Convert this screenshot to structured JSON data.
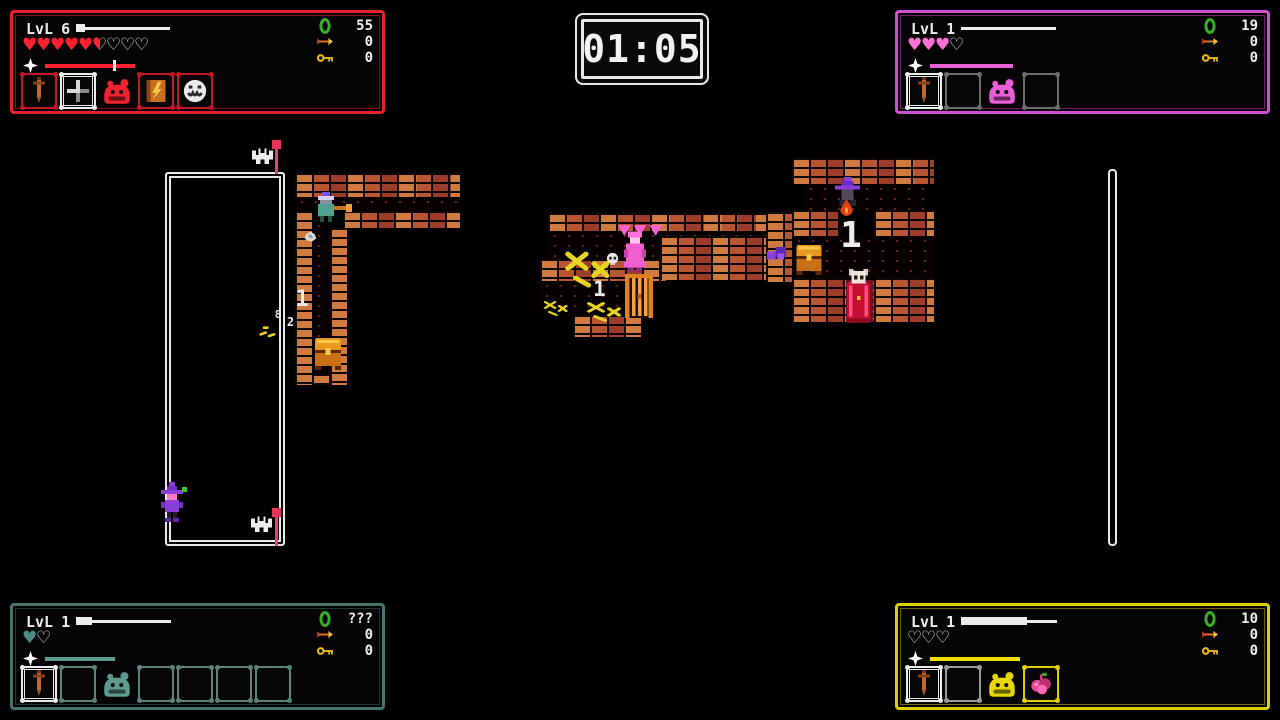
{
  "timer": {
    "value": "01:05"
  },
  "hud": {
    "level_label": "LvL"
  },
  "players": [
    {
      "name": "player-red",
      "corner": "top-left",
      "level": "6",
      "colors": {
        "frame": "#e8212f",
        "frame_dim": "#8a1018",
        "slot_dim": "#c41724",
        "heart": "#ff2030",
        "bar": "#ff2030",
        "slime": "#ee2230"
      },
      "hearts": {
        "full": 5,
        "half": 1,
        "empty": 3
      },
      "xp": {
        "track_w": 94,
        "fill_w": 9
      },
      "wrath": {
        "bar_w": 90,
        "marker": 0.76
      },
      "counters": [
        {
          "icon": "gem",
          "value": "55"
        },
        {
          "icon": "arrow",
          "value": "0"
        },
        {
          "icon": "key",
          "value": "0"
        }
      ],
      "slots": [
        {
          "icon": "sword",
          "frame": "dim"
        },
        {
          "icon": "crosshair",
          "frame": "selected"
        },
        {
          "icon": "slime",
          "frame": "none"
        },
        {
          "icon": "spellbook",
          "frame": "dim"
        },
        {
          "icon": "mask",
          "frame": "dim"
        }
      ]
    },
    {
      "name": "player-pink",
      "corner": "top-right",
      "level": "1",
      "colors": {
        "frame": "#cf4ecf",
        "frame_dim": "#701f70",
        "slot_dim": "#6e6e6e",
        "heart": "#ff70d8",
        "bar": "#ea5ed8",
        "slime": "#ea5ed8"
      },
      "hearts": {
        "full": 3,
        "half": 0,
        "empty": 1
      },
      "xp": {
        "track_w": 95,
        "fill_w": 0
      },
      "wrath": {
        "bar_w": 83,
        "marker": null
      },
      "counters": [
        {
          "icon": "gem",
          "value": "19"
        },
        {
          "icon": "arrow",
          "value": "0"
        },
        {
          "icon": "key",
          "value": "0"
        }
      ],
      "slots": [
        {
          "icon": "sword",
          "frame": "selected"
        },
        {
          "icon": "empty",
          "frame": "dim"
        },
        {
          "icon": "slime",
          "frame": "none"
        },
        {
          "icon": "empty",
          "frame": "dim"
        }
      ]
    },
    {
      "name": "player-teal",
      "corner": "bottom-left",
      "level": "1",
      "colors": {
        "frame": "#44766e",
        "frame_dim": "#1f3a36",
        "slot_dim": "#5d837c",
        "heart": "#4f8c80",
        "bar": "#5d9b8d",
        "slime": "#5d9b8d"
      },
      "hearts": {
        "full": 1,
        "half": 0,
        "empty": 1
      },
      "xp": {
        "track_w": 95,
        "fill_w": 16
      },
      "wrath": {
        "bar_w": 70,
        "marker": null
      },
      "counters": [
        {
          "icon": "gem",
          "value": "???"
        },
        {
          "icon": "arrow",
          "value": "0"
        },
        {
          "icon": "key",
          "value": "0"
        }
      ],
      "slots": [
        {
          "icon": "sword",
          "frame": "selected"
        },
        {
          "icon": "empty",
          "frame": "dim"
        },
        {
          "icon": "slime",
          "frame": "none"
        },
        {
          "icon": "empty",
          "frame": "dim"
        },
        {
          "icon": "empty",
          "frame": "dim"
        },
        {
          "icon": "empty",
          "frame": "dim"
        },
        {
          "icon": "empty",
          "frame": "dim"
        }
      ]
    },
    {
      "name": "player-yellow",
      "corner": "bottom-right",
      "level": "1",
      "colors": {
        "frame": "#ded000",
        "frame_dim": "#6e6700",
        "slot_dim": "#9a9a9a",
        "heart": "#ded000",
        "bar": "#f0e000",
        "slime": "#e6d700"
      },
      "hearts": {
        "full": 0,
        "half": 0,
        "empty": 3
      },
      "xp": {
        "track_w": 96,
        "fill_w": 66
      },
      "wrath": {
        "bar_w": 90,
        "marker": null
      },
      "counters": [
        {
          "icon": "gem",
          "value": "10"
        },
        {
          "icon": "arrow",
          "value": "0"
        },
        {
          "icon": "key",
          "value": "0"
        }
      ],
      "slots": [
        {
          "icon": "sword",
          "frame": "selected"
        },
        {
          "icon": "empty",
          "frame": "dim"
        },
        {
          "icon": "slime",
          "frame": "none"
        },
        {
          "icon": "berries",
          "frame": "accent"
        }
      ]
    }
  ],
  "map": {
    "sprites": [
      {
        "name": "left-room-outline",
        "type": "room",
        "x": 165,
        "y": 172,
        "w": 120,
        "h": 374
      },
      {
        "name": "right-room-wall",
        "type": "wallv",
        "x": 1108,
        "y": 169,
        "w": 9,
        "h": 377
      },
      {
        "name": "brick-wall",
        "type": "brick",
        "x": 295,
        "y": 173,
        "w": 165,
        "h": 24
      },
      {
        "name": "corridor-floor",
        "type": "floor",
        "x": 295,
        "y": 197,
        "w": 165,
        "h": 14
      },
      {
        "name": "brick-wall",
        "type": "brick",
        "x": 343,
        "y": 211,
        "w": 117,
        "h": 17
      },
      {
        "name": "brick-wall",
        "type": "brick",
        "x": 295,
        "y": 211,
        "w": 17,
        "h": 174
      },
      {
        "name": "corridor-floor",
        "type": "floor",
        "x": 312,
        "y": 211,
        "w": 18,
        "h": 163
      },
      {
        "name": "brick-wall",
        "type": "brick",
        "x": 330,
        "y": 228,
        "w": 17,
        "h": 157
      },
      {
        "name": "brick-wall",
        "type": "brick",
        "x": 312,
        "y": 374,
        "w": 18,
        "h": 11
      },
      {
        "name": "brick-wall",
        "type": "brick",
        "x": 548,
        "y": 213,
        "w": 222,
        "h": 18
      },
      {
        "name": "corridor-floor",
        "type": "floor",
        "x": 548,
        "y": 231,
        "w": 222,
        "h": 28
      },
      {
        "name": "brick-wall",
        "type": "brick",
        "x": 540,
        "y": 259,
        "w": 126,
        "h": 22
      },
      {
        "name": "corridor-floor",
        "type": "floor",
        "x": 540,
        "y": 281,
        "w": 102,
        "h": 34
      },
      {
        "name": "brick-wall",
        "type": "brick",
        "x": 573,
        "y": 315,
        "w": 68,
        "h": 22
      },
      {
        "name": "brick-wall",
        "type": "brick",
        "x": 660,
        "y": 236,
        "w": 134,
        "h": 44
      },
      {
        "name": "brick-wall",
        "type": "brick",
        "x": 766,
        "y": 212,
        "w": 28,
        "h": 70
      },
      {
        "name": "brick-wall",
        "type": "brick",
        "x": 792,
        "y": 158,
        "w": 142,
        "h": 26
      },
      {
        "name": "room-floor",
        "type": "floor",
        "x": 804,
        "y": 184,
        "w": 120,
        "h": 26
      },
      {
        "name": "brick-wall",
        "type": "brick",
        "x": 792,
        "y": 210,
        "w": 46,
        "h": 26
      },
      {
        "name": "brick-wall",
        "type": "brick",
        "x": 874,
        "y": 210,
        "w": 60,
        "h": 26
      },
      {
        "name": "room-floor",
        "type": "floor",
        "x": 792,
        "y": 236,
        "w": 142,
        "h": 42
      },
      {
        "name": "brick-wall",
        "type": "brick",
        "x": 792,
        "y": 278,
        "w": 56,
        "h": 44
      },
      {
        "name": "brick-wall",
        "type": "brick",
        "x": 874,
        "y": 278,
        "w": 60,
        "h": 44
      },
      {
        "name": "red-carpet",
        "type": "carpet",
        "x": 846,
        "y": 280,
        "w": 28,
        "h": 42
      },
      {
        "name": "flag",
        "type": "flag",
        "x": 272,
        "y": 140,
        "w": 10,
        "h": 34
      },
      {
        "name": "ghost",
        "type": "ghost",
        "x": 252,
        "y": 146,
        "w": 21,
        "h": 18
      },
      {
        "name": "flag",
        "type": "flag",
        "x": 272,
        "y": 508,
        "w": 10,
        "h": 38
      },
      {
        "name": "ghost",
        "type": "ghost",
        "x": 251,
        "y": 514,
        "w": 21,
        "h": 18
      },
      {
        "name": "witch-hero",
        "type": "witch",
        "x": 159,
        "y": 482,
        "w": 26,
        "h": 42
      },
      {
        "name": "green-pickup",
        "type": "dot",
        "x": 182,
        "y": 487,
        "w": 5,
        "h": 5,
        "color": "#3ec626"
      },
      {
        "name": "wizard-npc",
        "type": "wizmint",
        "x": 314,
        "y": 192,
        "w": 38,
        "h": 32
      },
      {
        "name": "rock",
        "type": "blob",
        "x": 303,
        "y": 228,
        "w": 15,
        "h": 13
      },
      {
        "name": "floor-number",
        "type": "label",
        "x": 292,
        "y": 286,
        "w": 20,
        "h": 28,
        "label": "1",
        "size": 22
      },
      {
        "name": "damage-number",
        "type": "label",
        "x": 272,
        "y": 307,
        "w": 12,
        "h": 15,
        "label": "8",
        "size": 11
      },
      {
        "name": "damage-number",
        "type": "label",
        "x": 284,
        "y": 314,
        "w": 13,
        "h": 17,
        "label": "2",
        "size": 12
      },
      {
        "name": "debris",
        "type": "dashes",
        "x": 259,
        "y": 323,
        "w": 20,
        "h": 14
      },
      {
        "name": "chest",
        "type": "chest",
        "x": 313,
        "y": 334,
        "w": 30,
        "h": 36
      },
      {
        "name": "pink-spikes",
        "type": "spikes",
        "x": 617,
        "y": 222,
        "w": 46,
        "h": 13
      },
      {
        "name": "pink-hero",
        "type": "pinkhero",
        "x": 620,
        "y": 231,
        "w": 30,
        "h": 43
      },
      {
        "name": "skull",
        "type": "skull",
        "x": 605,
        "y": 251,
        "w": 15,
        "h": 14
      },
      {
        "name": "bones",
        "type": "bones",
        "x": 560,
        "y": 242,
        "w": 52,
        "h": 48
      },
      {
        "name": "floor-number",
        "type": "label",
        "x": 591,
        "y": 276,
        "w": 17,
        "h": 27,
        "label": "1",
        "size": 21
      },
      {
        "name": "gate",
        "type": "gate",
        "x": 624,
        "y": 274,
        "w": 30,
        "h": 44
      },
      {
        "name": "bones",
        "type": "bones",
        "x": 583,
        "y": 297,
        "w": 40,
        "h": 26
      },
      {
        "name": "bones",
        "type": "bones",
        "x": 541,
        "y": 297,
        "w": 28,
        "h": 20
      },
      {
        "name": "purple-pickup",
        "type": "itempurple",
        "x": 765,
        "y": 244,
        "w": 23,
        "h": 21
      },
      {
        "name": "wizard-npc",
        "type": "wizpurple",
        "x": 831,
        "y": 177,
        "w": 33,
        "h": 29
      },
      {
        "name": "fire",
        "type": "fire",
        "x": 837,
        "y": 199,
        "w": 19,
        "h": 19
      },
      {
        "name": "floor-number",
        "type": "label",
        "x": 840,
        "y": 213,
        "w": 22,
        "h": 45,
        "label": "1",
        "size": 36
      },
      {
        "name": "chest",
        "type": "chest",
        "x": 793,
        "y": 241,
        "w": 32,
        "h": 34
      },
      {
        "name": "cultist",
        "type": "cultist",
        "x": 843,
        "y": 269,
        "w": 31,
        "h": 54
      }
    ]
  }
}
